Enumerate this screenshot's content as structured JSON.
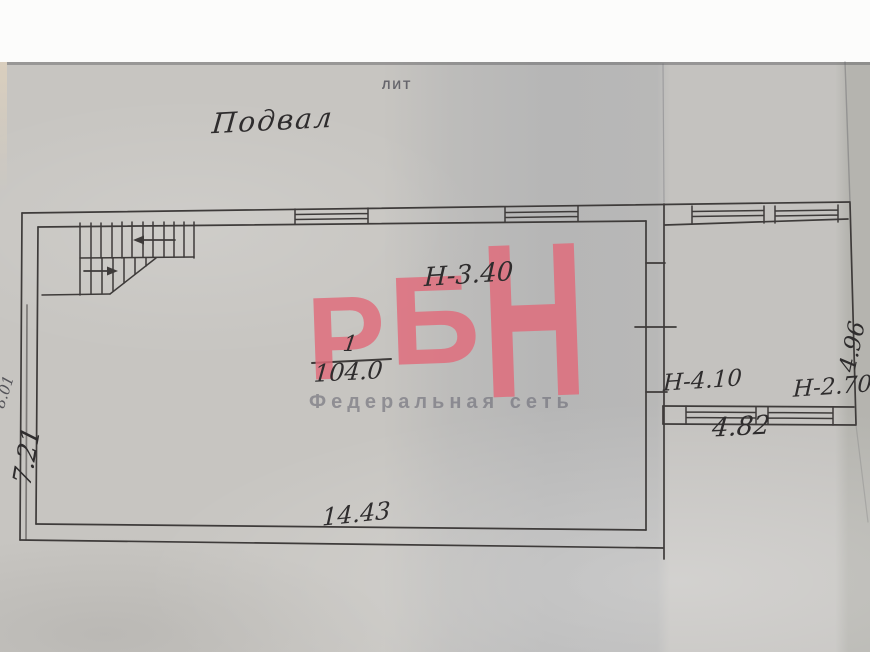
{
  "document": {
    "lit_label": "ЛИТ",
    "title": "Подвал"
  },
  "watermark": {
    "logo_letters": [
      "Р",
      "Б",
      "Н"
    ],
    "tagline": "Федеральная сеть",
    "logo_color": "#e06a7a",
    "tagline_color": "#6c6c78"
  },
  "plan": {
    "main_room": {
      "number": "1",
      "area": "104.0",
      "height_label": "Н-3.40",
      "bottom_dimension": "14.43",
      "left_dimension": "7.21",
      "outer_left_dimension": "8.01"
    },
    "annex": {
      "height_label_left": "Н-4.10",
      "height_label_right": "Н-2.70",
      "bottom_dimension": "4.82",
      "right_dimension": "4.96"
    }
  }
}
